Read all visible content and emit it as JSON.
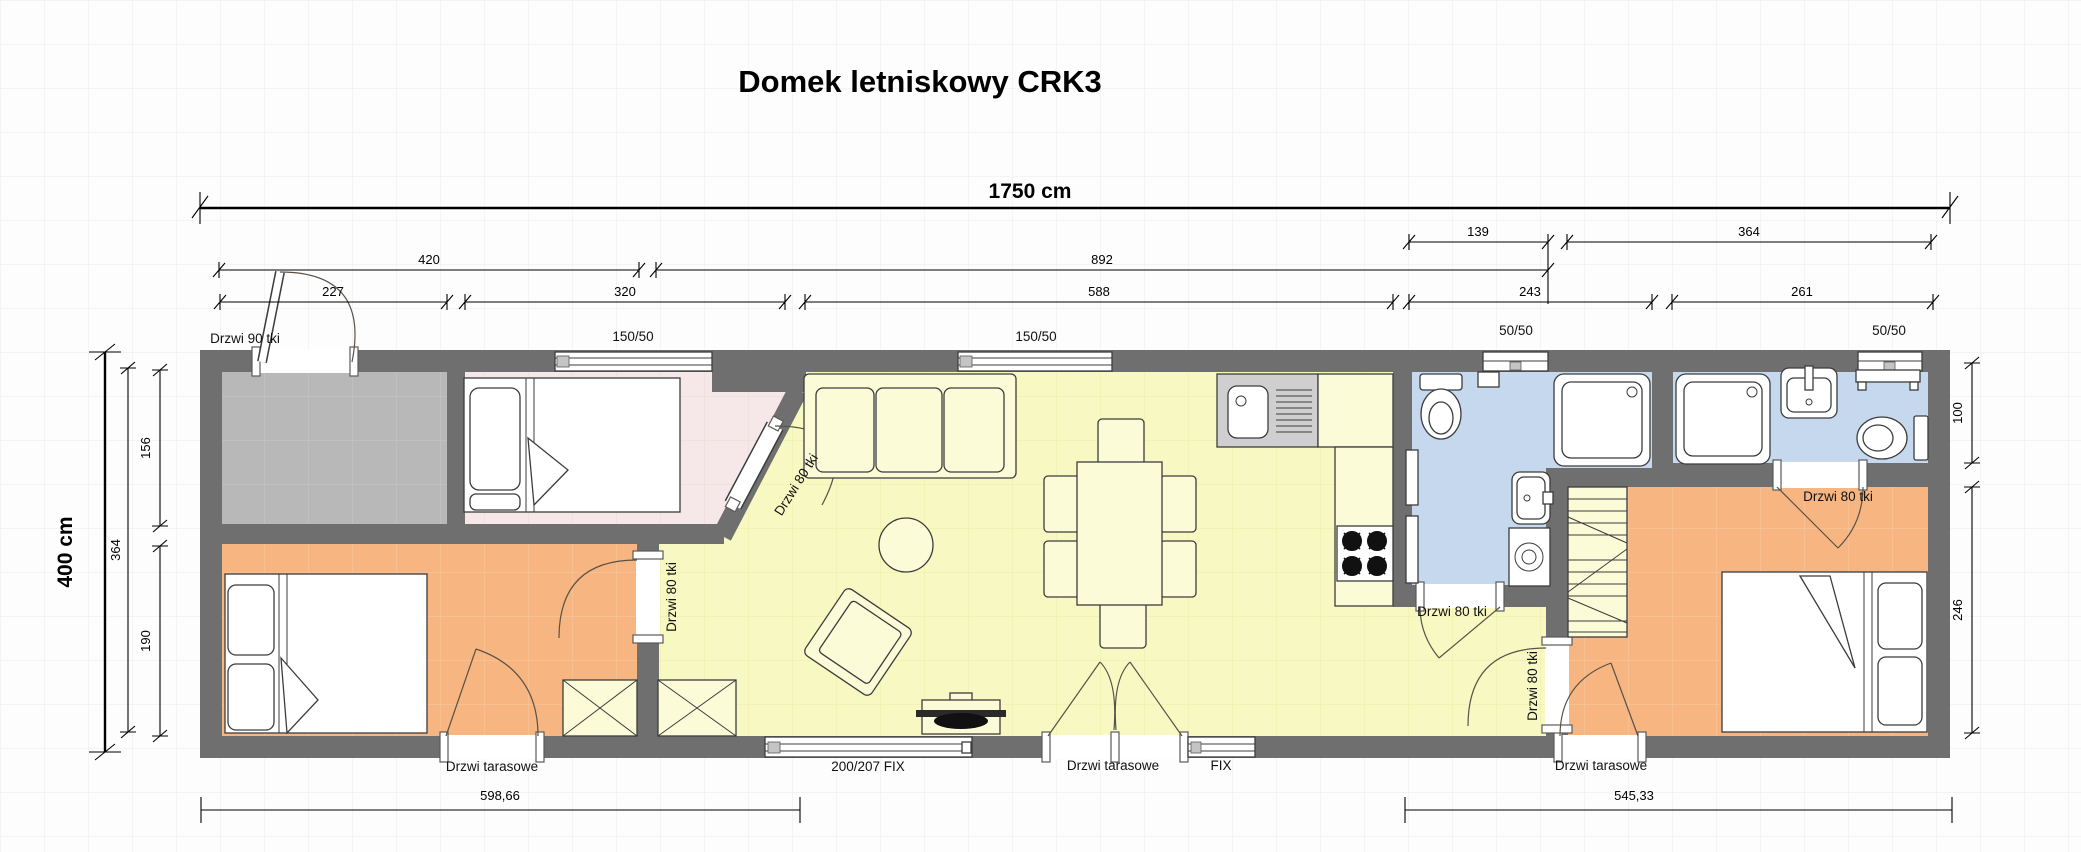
{
  "title": "Domek letniskowy CRK3",
  "dims": {
    "total_width": "1750 cm",
    "total_height": "400 cm",
    "row_a": [
      "139",
      "364"
    ],
    "row_b": [
      "420",
      "892"
    ],
    "row_c": [
      "227",
      "320",
      "588",
      "243",
      "261"
    ],
    "left": [
      "364",
      "156",
      "190"
    ],
    "right": [
      "100",
      "246"
    ],
    "bottom": [
      "598,66",
      "545,33"
    ]
  },
  "windows": {
    "w150": "150/50",
    "w50": "50/50",
    "fix200": "200/207 FIX",
    "fix": "FIX"
  },
  "doors": {
    "d90": "Drzwi 90 tki",
    "d80": "Drzwi 80 tki",
    "terrace": "Drzwi tarasowe"
  },
  "colors": {
    "wall": "#6f6f6f",
    "living": "#f8f8c2",
    "bedroom_orange": "#f6b581",
    "bathroom_blue": "#c5d8ed",
    "room_pink": "#f6e8e8",
    "terrace_gray": "#b8b8b8"
  }
}
